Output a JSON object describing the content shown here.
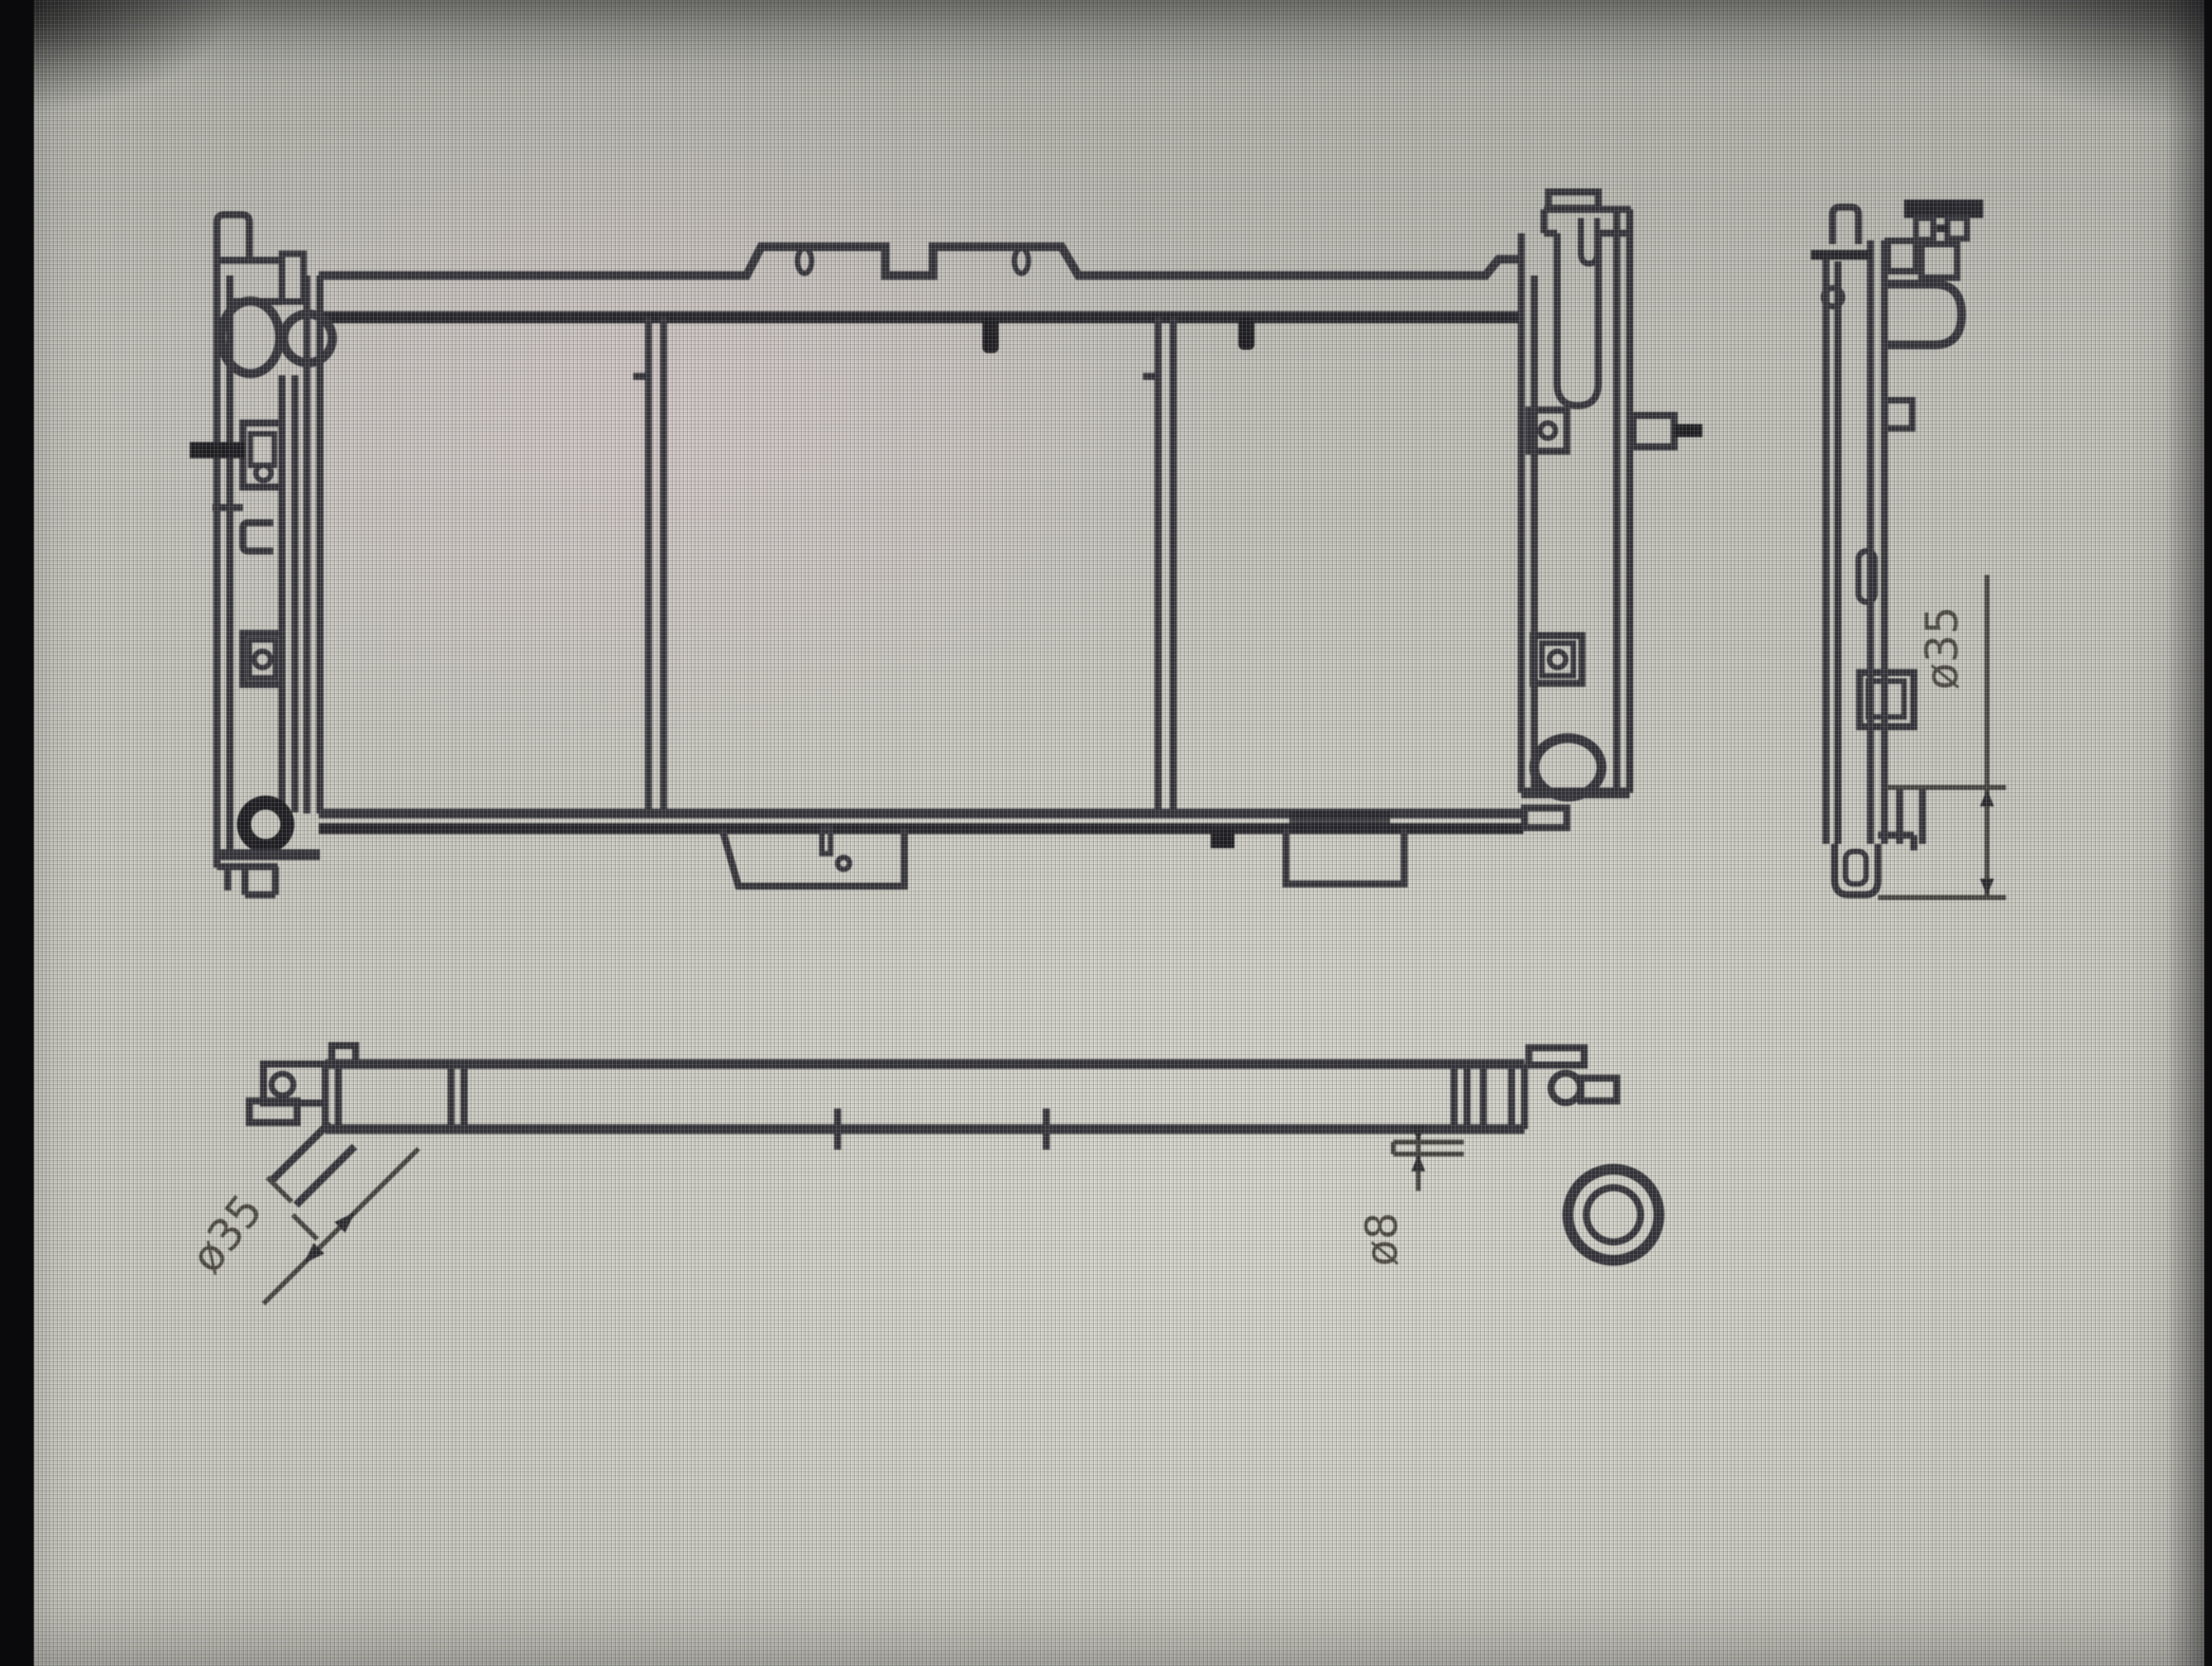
{
  "drawing": {
    "annotations": {
      "side_outlet_diameter": {
        "label": "ø35"
      },
      "bottom_left_outlet_diameter": {
        "label": "ø35"
      },
      "bottom_right_drain_diameter": {
        "label": "ø8"
      }
    },
    "colors": {
      "line": "#34333a",
      "line_dark": "#1d1c21",
      "label_ink": "#4a4540",
      "screen_background": "#c8c7c0",
      "bezel": "#0a0a0c"
    }
  }
}
